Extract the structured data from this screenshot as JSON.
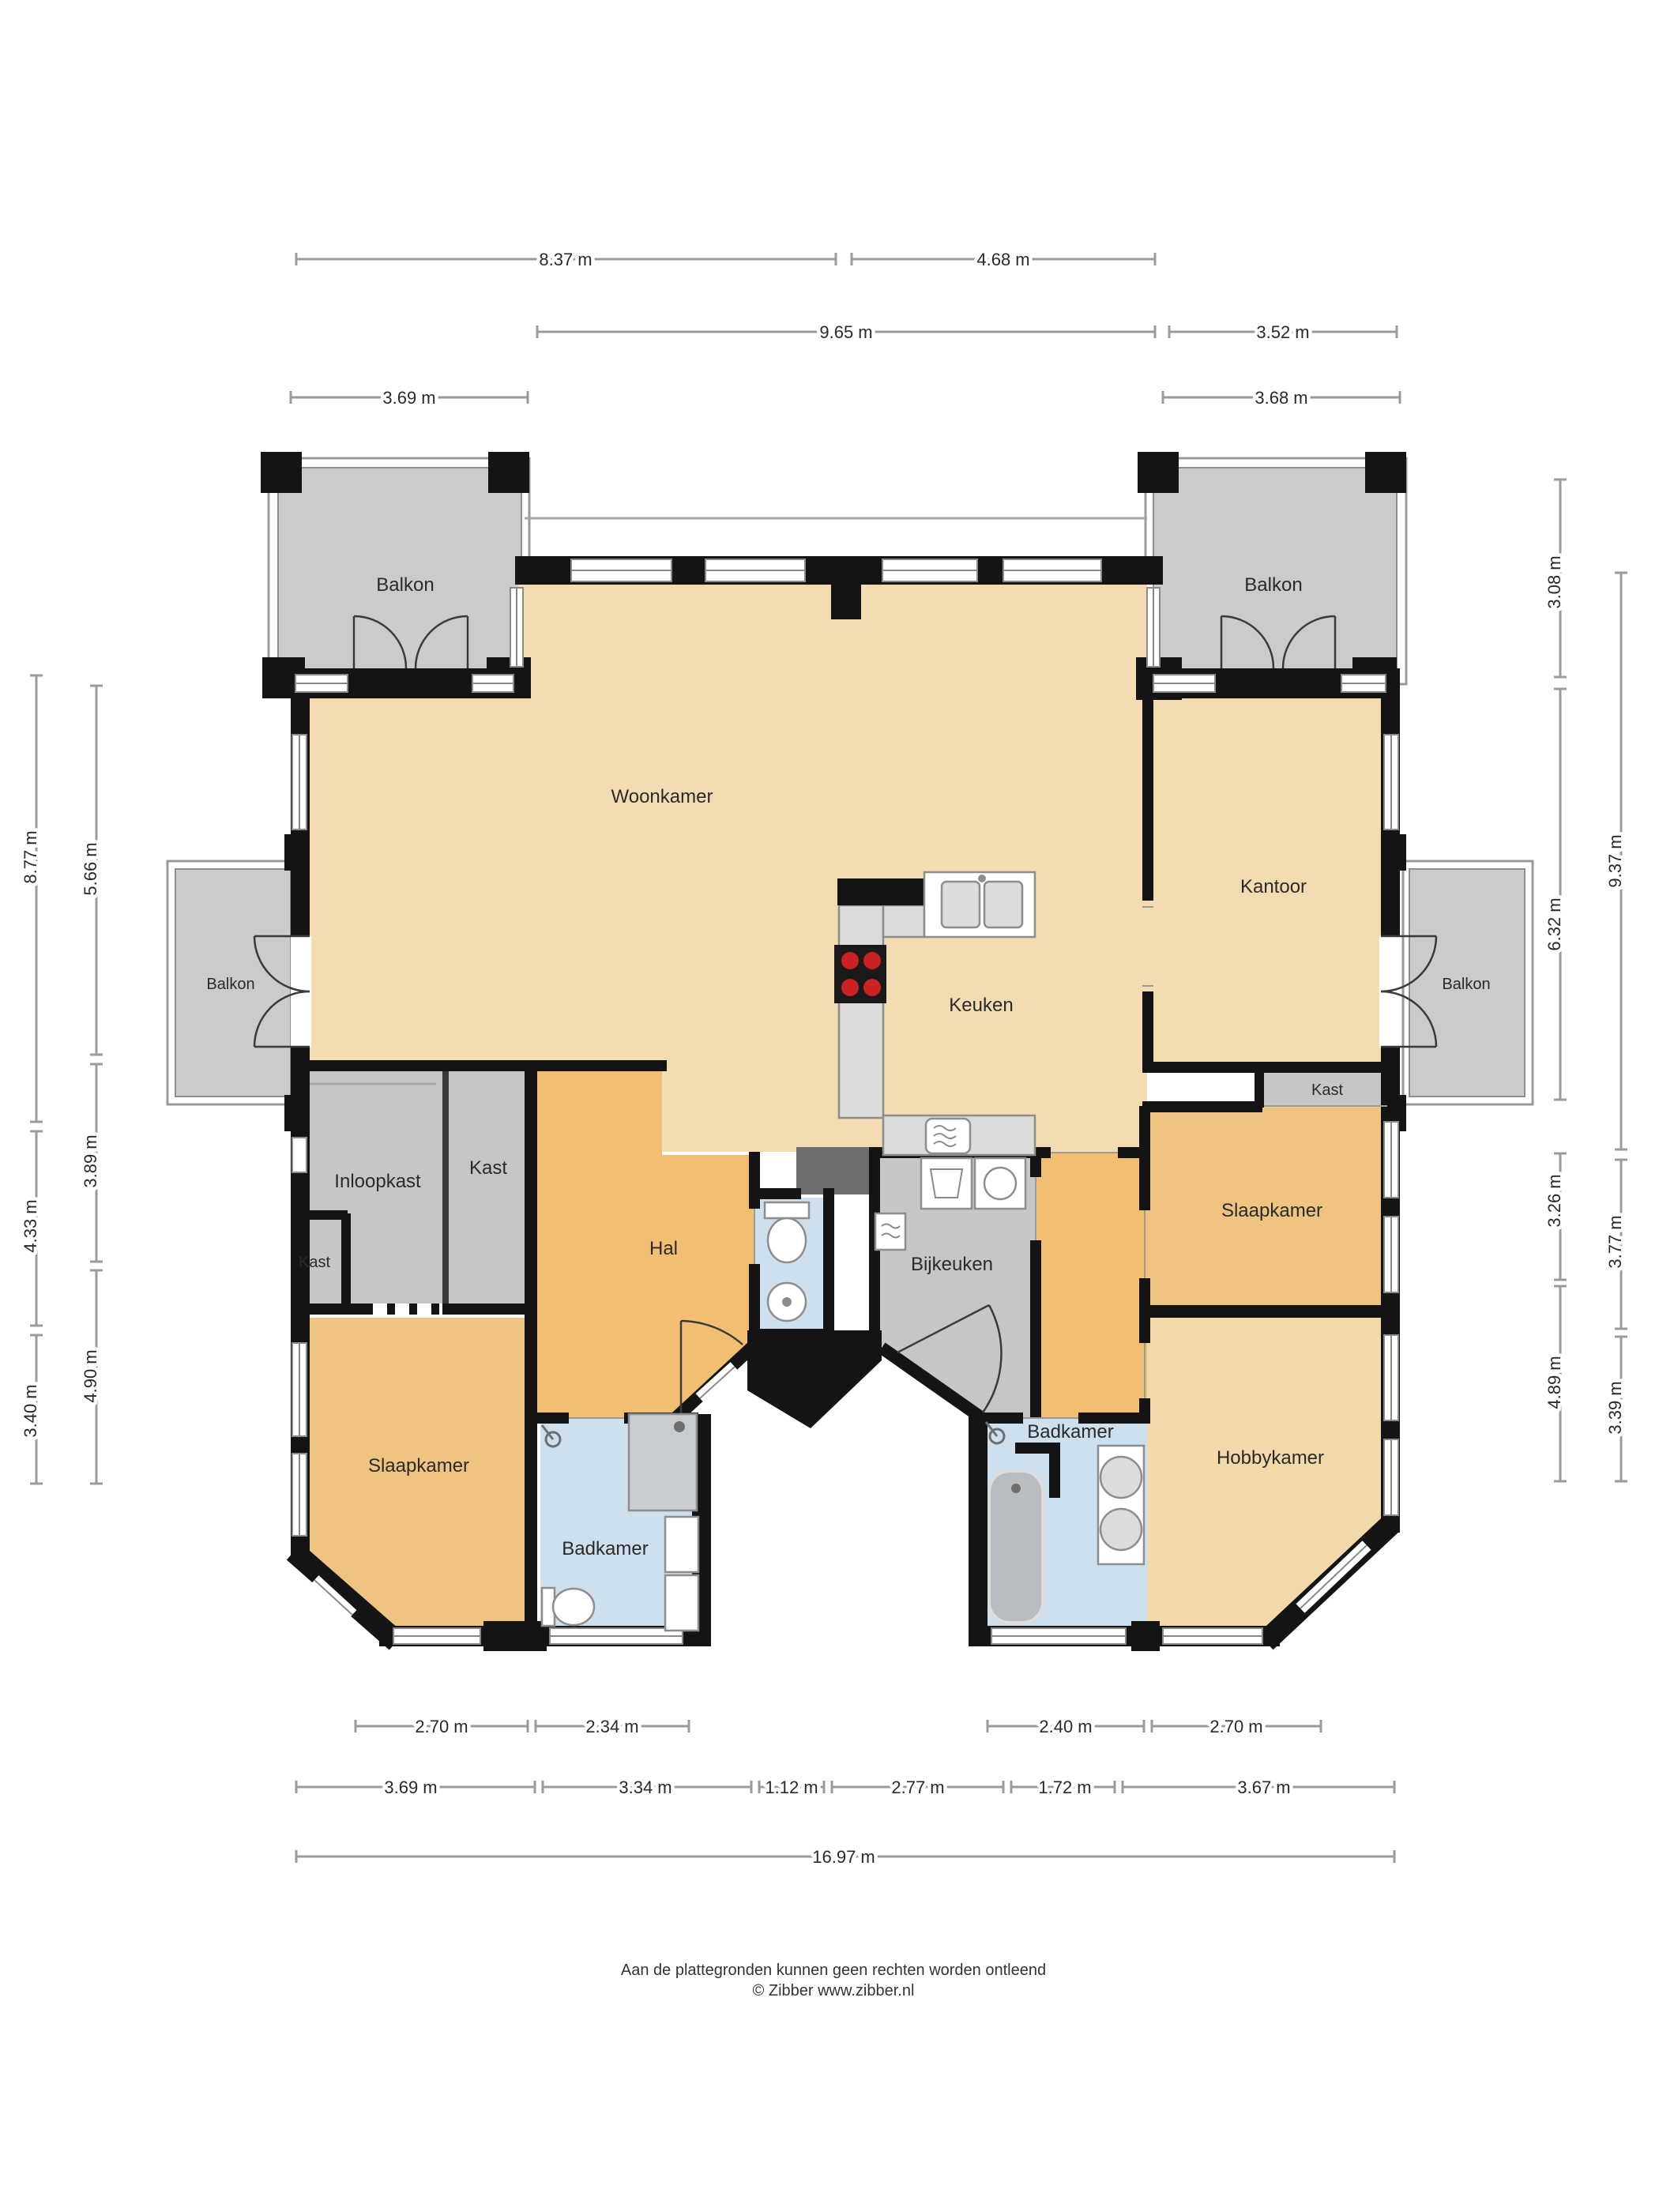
{
  "document": {
    "type": "floor-plan",
    "language": "nl",
    "footer": {
      "line1": "Aan de plattegronden kunnen geen rechten worden ontleend",
      "line2": "© Zibber www.zibber.nl"
    }
  },
  "colors": {
    "wall": "#141414",
    "living_fill": "#f4dcb2",
    "hobby_fill": "#f2d9a9",
    "hall_fill": "#f2bf72",
    "bedroom_fill": "#efc480",
    "bathroom_fill": "#cedfee",
    "closet_balcony_fill": "#c6c6c6",
    "shaft_fill": "#6e6e6e",
    "burner_red": "#cc2222",
    "dimension_line": "#9b9b9b"
  },
  "rooms": {
    "balkon_top_left": "Balkon",
    "balkon_top_right": "Balkon",
    "balkon_left": "Balkon",
    "balkon_right": "Balkon",
    "woonkamer": "Woonkamer",
    "kantoor": "Kantoor",
    "keuken": "Keuken",
    "kast_kantoor": "Kast",
    "inloopkast": "Inloopkast",
    "kast_hal": "Kast",
    "kast_klein": "Kast",
    "hal": "Hal",
    "bijkeuken": "Bijkeuken",
    "slaapkamer_rechts": "Slaapkamer",
    "slaapkamer_links": "Slaapkamer",
    "badkamer_links": "Badkamer",
    "badkamer_rechts": "Badkamer",
    "hobbykamer": "Hobbykamer"
  },
  "dims": {
    "top1": [
      "8.37 m",
      "4.68 m"
    ],
    "top2": [
      "9.65 m",
      "3.52 m"
    ],
    "top3": [
      "3.69 m",
      "3.68 m"
    ],
    "bottom1": [
      "2.70 m",
      "2.34 m",
      "2.40 m",
      "2.70 m"
    ],
    "bottom2": [
      "3.69 m",
      "3.34 m",
      "1.12 m",
      "2.77 m",
      "1.72 m",
      "3.67 m"
    ],
    "bottom3": [
      "16.97 m"
    ],
    "left_outer": [
      "8.77 m",
      "4.33 m",
      "3.40 m"
    ],
    "left_inner": [
      "5.66 m",
      "3.89 m",
      "4.90 m"
    ],
    "right_inner": [
      "3.08 m",
      "6.32 m",
      "3.26 m",
      "4.89 m"
    ],
    "right_outer": [
      "9.37 m",
      "3.77 m",
      "3.39 m"
    ]
  }
}
